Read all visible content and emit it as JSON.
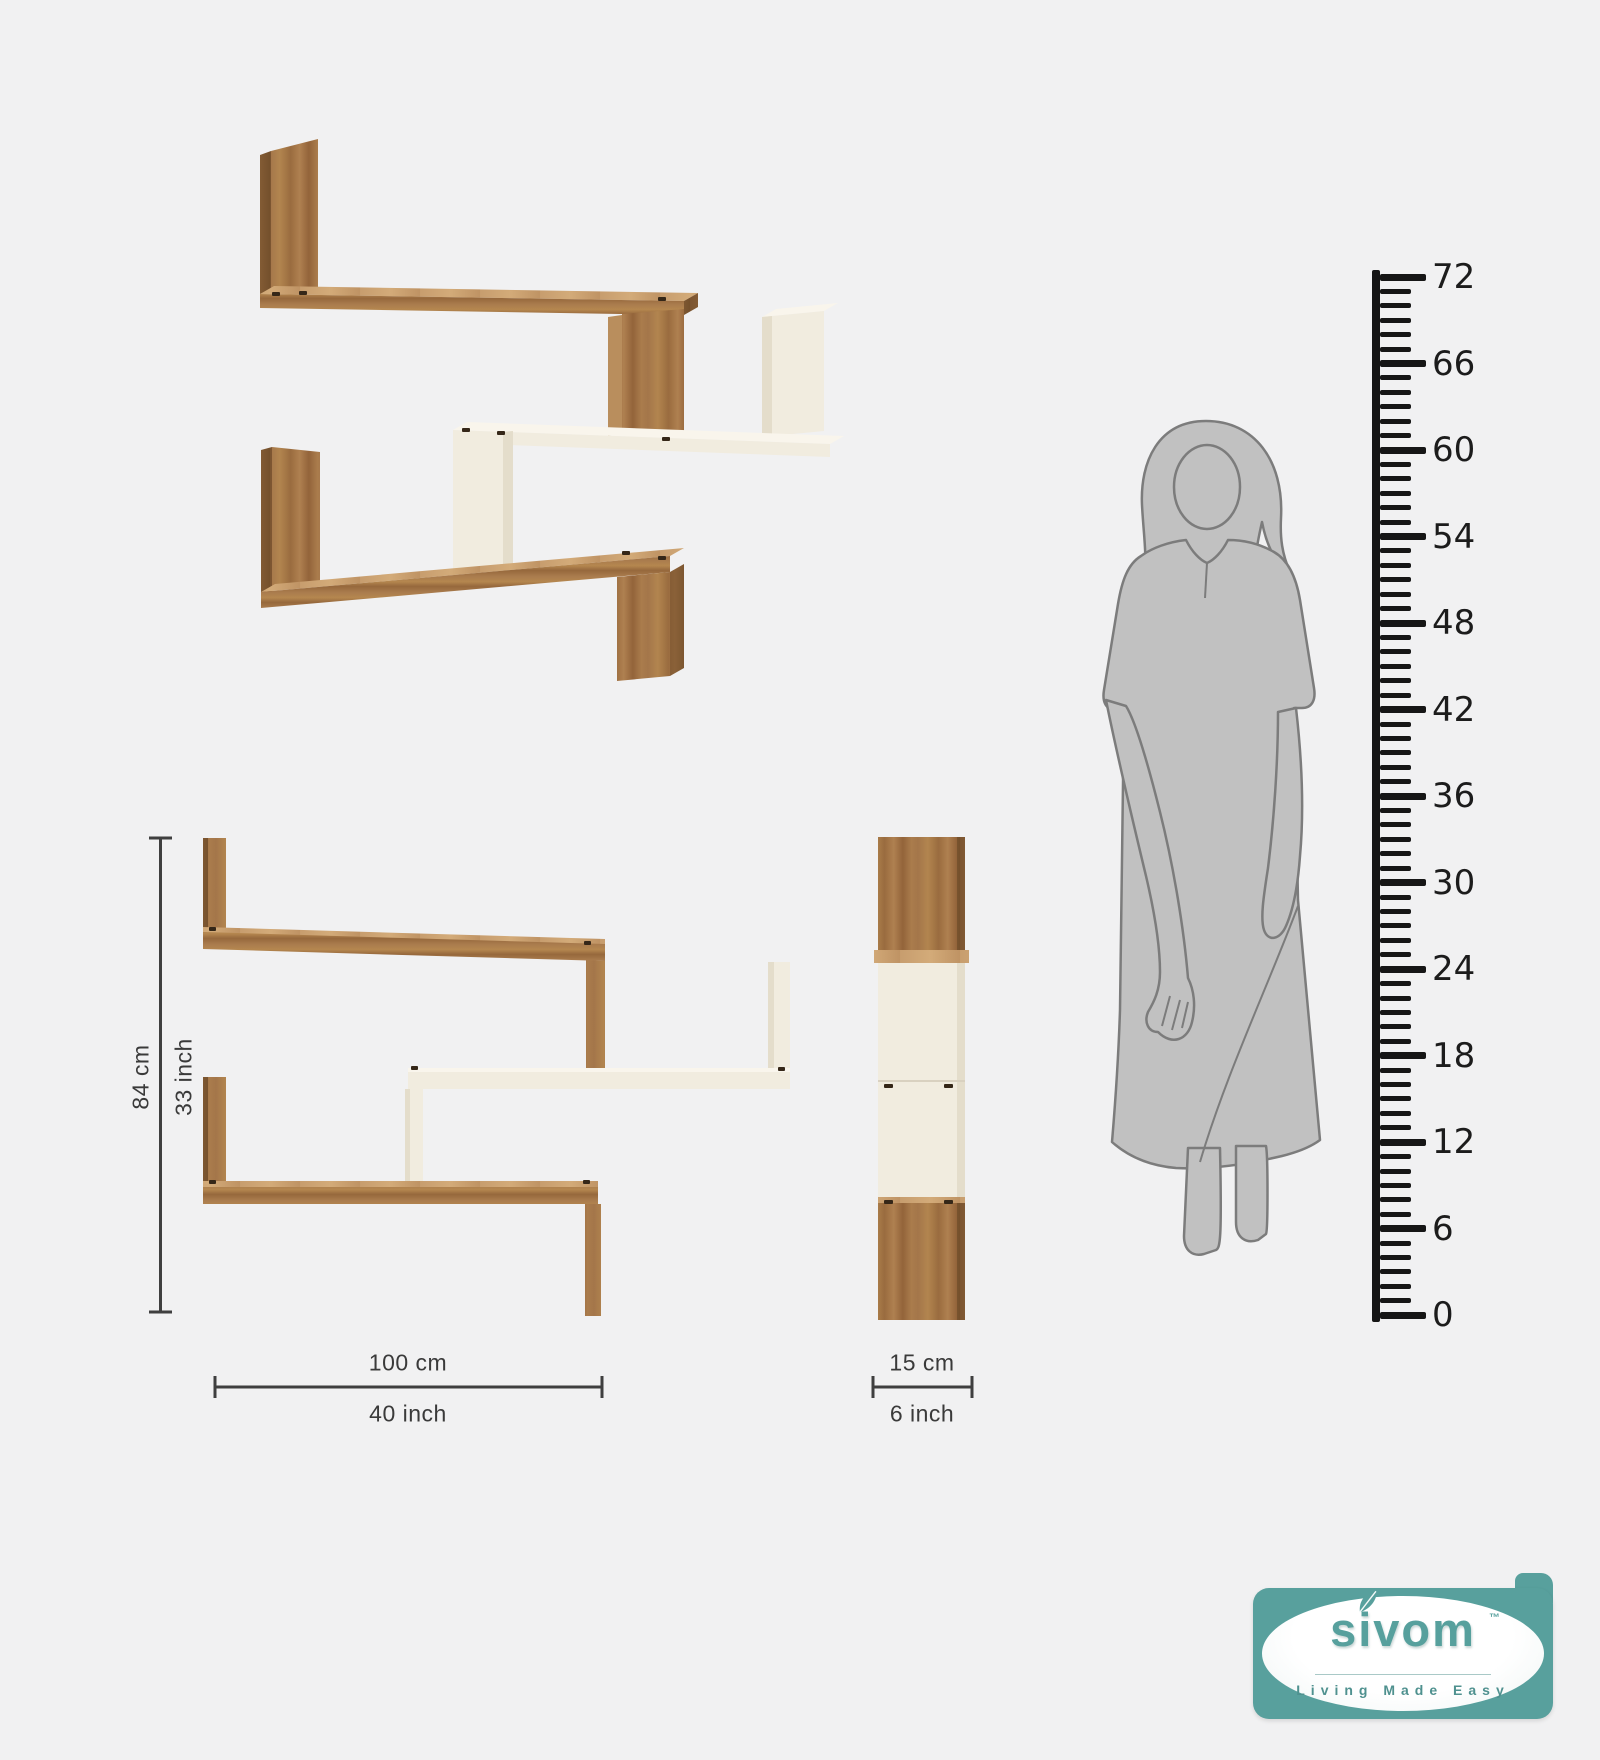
{
  "dimensions": {
    "height": {
      "cm": "84 cm",
      "inch": "33 inch"
    },
    "width": {
      "cm": "100 cm",
      "inch": "40 inch"
    },
    "depth": {
      "cm": "15 cm",
      "inch": "6 inch"
    }
  },
  "ruler": {
    "min": 0,
    "max": 72,
    "label_step": 6,
    "minor_step": 1
  },
  "logo": {
    "brand": "sivom",
    "trademark": "TM",
    "tagline": "Living Made Easy"
  },
  "colors": {
    "background": "#f1f1f2",
    "wood": "#a4764a",
    "wood_dark": "#7c5531",
    "wood_light": "#c79d6e",
    "cream": "#f1ecdf",
    "cream_shade": "#e4ddcb",
    "silhouette_fill": "#c1c1c1",
    "silhouette_line": "#7c7c7c",
    "dimension_line": "#3f3f3f",
    "ruler_ink": "#161616",
    "logo_teal": "#58a09d",
    "logo_tagline": "#4f918f"
  }
}
